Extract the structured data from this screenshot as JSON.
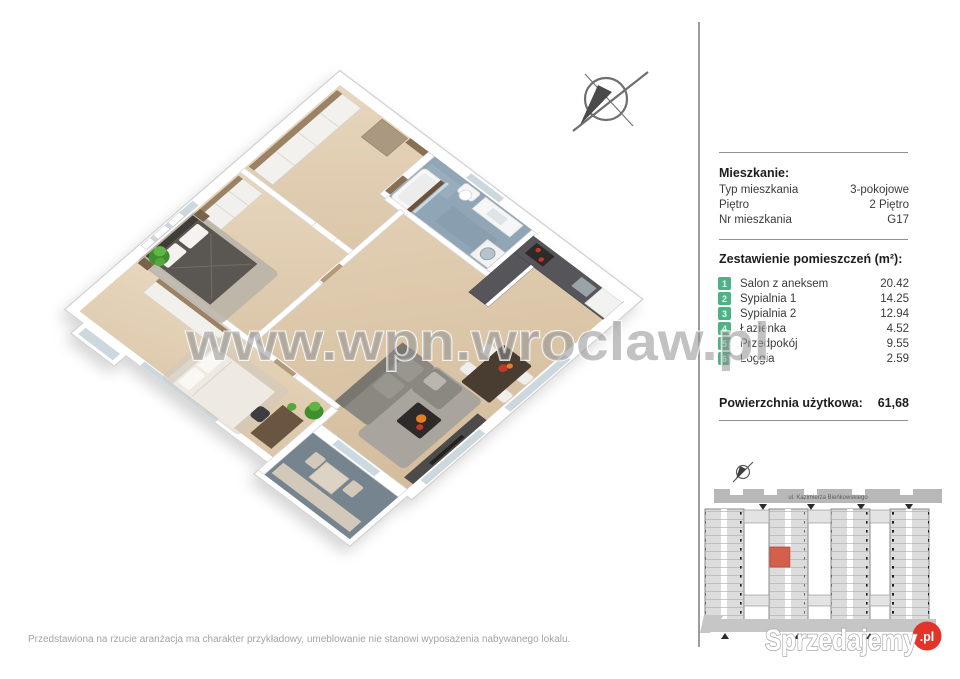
{
  "watermark": {
    "text": "www.wpn.wroclaw.pl",
    "color": "#8f8f8f"
  },
  "floor_plan": {
    "compass_icon": "north-arrow-compass"
  },
  "panel": {
    "accent_color": "#4eb187",
    "apartment": {
      "title": "Mieszkanie:",
      "rows": [
        {
          "label": "Typ mieszkania",
          "value": "3-pokojowe"
        },
        {
          "label": "Piętro",
          "value": "2 Piętro"
        },
        {
          "label": "Nr mieszkania",
          "value": "G17"
        }
      ]
    },
    "rooms_section": {
      "title": "Zestawienie pomieszczeń (m²):",
      "rooms": [
        {
          "no": "1",
          "name": "Salon z aneksem",
          "area": "20.42"
        },
        {
          "no": "2",
          "name": "Sypialnia 1",
          "area": "14.25"
        },
        {
          "no": "3",
          "name": "Sypialnia 2",
          "area": "12.94"
        },
        {
          "no": "4",
          "name": "Łazienka",
          "area": "4.52"
        },
        {
          "no": "5",
          "name": "Przedpokój",
          "area": "9.55"
        },
        {
          "no": "6",
          "name": "Loggia",
          "area": "2.59"
        }
      ]
    },
    "total": {
      "label": "Powierzchnia użytkowa:",
      "value": "61,68"
    }
  },
  "site_plan": {
    "street_label": "ul. Kazimierza Bieńkowskiego",
    "highlight_color": "#d2604c",
    "compass_icon": "north-arrow-compass"
  },
  "footer": {
    "disclaimer": "Przedstawiona na rzucie aranżacja ma charakter przykładowy, umeblowanie nie stanowi wyposażenia nabywanego lokalu.",
    "logo": {
      "text": "Sprzedajemy",
      "tld": ".pl",
      "badge_color": "#e23428"
    }
  }
}
